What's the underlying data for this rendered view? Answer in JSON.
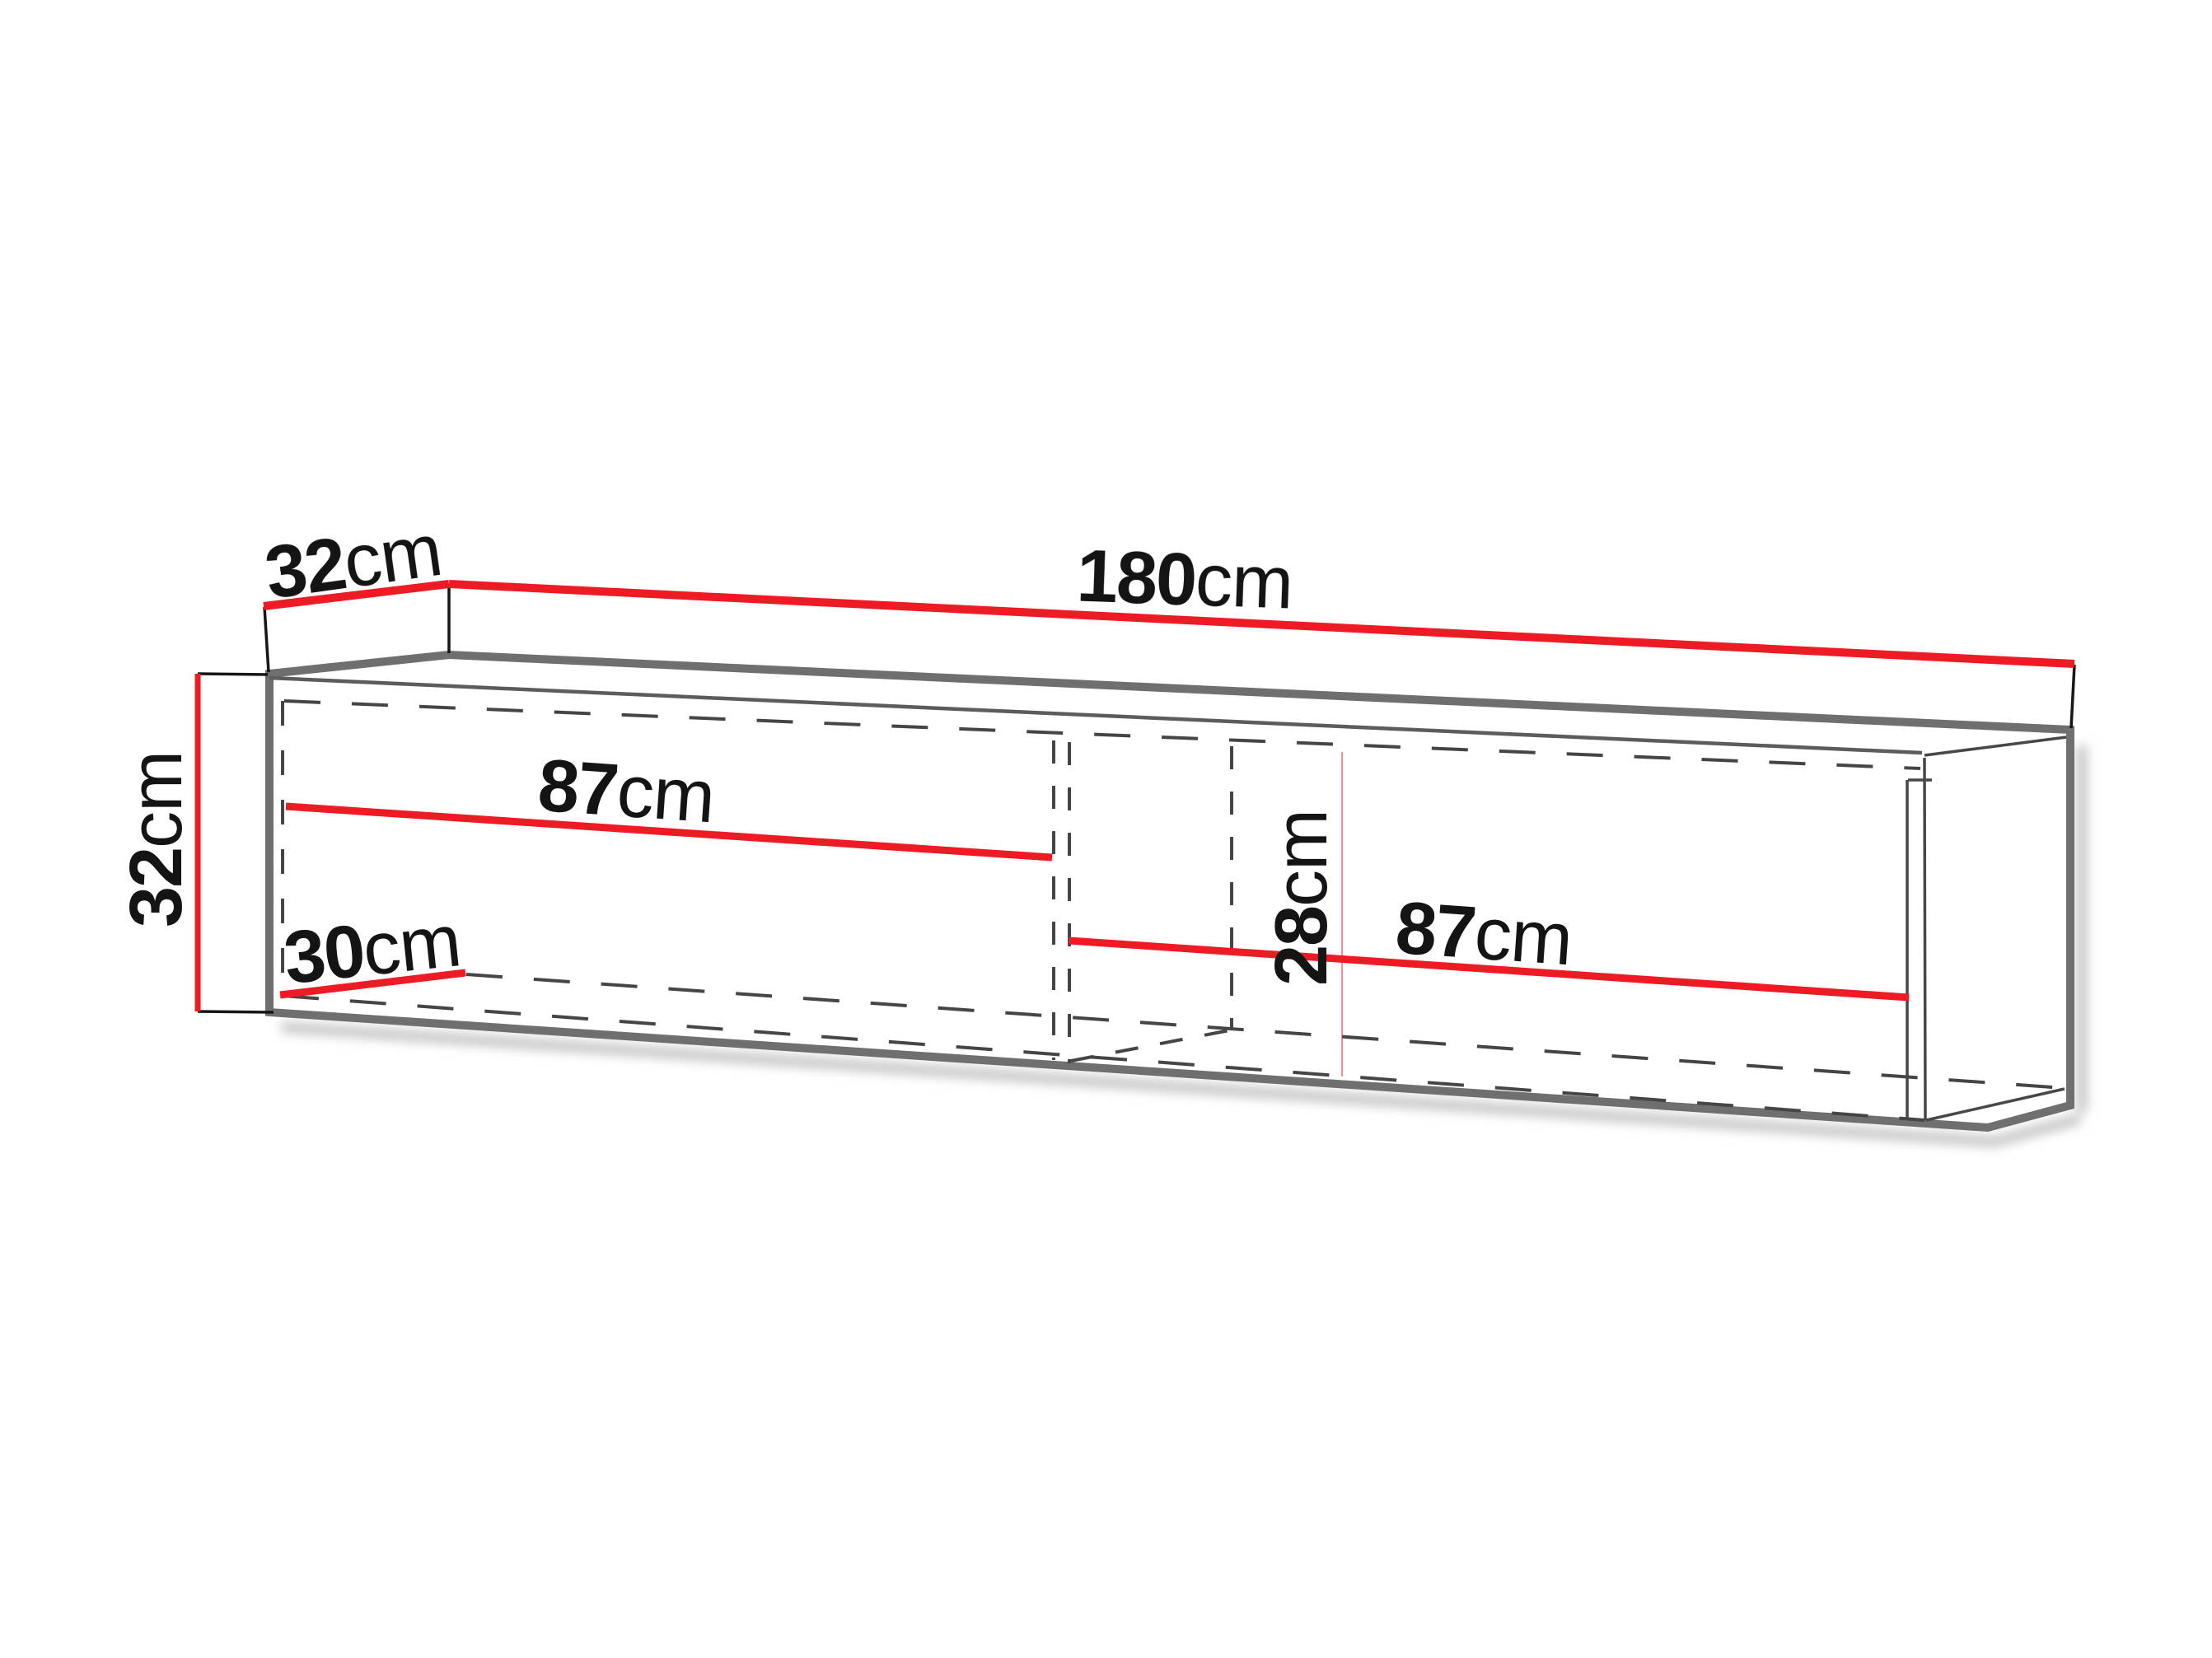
{
  "diagram": {
    "kind": "furniture-dimension-drawing",
    "subject": "wall-mounted cabinet with two open compartments, shown in perspective with hidden interior edges dashed",
    "background": "#FFFFFF",
    "colors": {
      "dimension_lines": "#ED1C24",
      "cabinet_outline": "#6F6F6F",
      "hidden_edges": "#454545",
      "label_text": "#141414",
      "shadow": "#9B9B9B"
    },
    "labels": {
      "top_depth": {
        "value": "32",
        "unit": "cm"
      },
      "top_width": {
        "value": "180",
        "unit": "cm"
      },
      "left_height": {
        "value": "32",
        "unit": "cm"
      },
      "left_compartment_width": {
        "value": "87",
        "unit": "cm"
      },
      "left_compartment_depth": {
        "value": "30",
        "unit": "cm"
      },
      "interior_height": {
        "value": "28",
        "unit": "cm"
      },
      "right_compartment_width": {
        "value": "87",
        "unit": "cm"
      }
    }
  }
}
